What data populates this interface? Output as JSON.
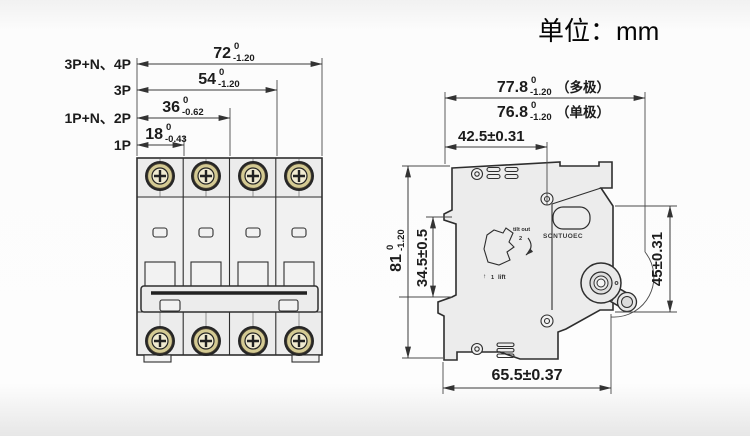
{
  "unit_label": "单位：mm",
  "front": {
    "labels": [
      "3P+N、4P",
      "3P",
      "1P+N、2P",
      "1P"
    ],
    "dims": [
      {
        "v": "72",
        "sup": "0",
        "sub": "-1.20"
      },
      {
        "v": "54",
        "sup": "0",
        "sub": "-1.20"
      },
      {
        "v": "36",
        "sup": "0",
        "sub": "-0.62"
      },
      {
        "v": "18",
        "sup": "0",
        "sub": "-0.43"
      }
    ]
  },
  "side": {
    "multi": {
      "v": "77.8",
      "sup": "0",
      "sub": "-1.20",
      "qual": "（多极）"
    },
    "single": {
      "v": "76.8",
      "sup": "0",
      "sub": "-1.20",
      "qual": "（单极）"
    },
    "d425": "42.5±0.31",
    "d81": {
      "v": "81",
      "sup": "0",
      "sub": "-1.20"
    },
    "d345": "34.5±0.5",
    "d45": "45±0.31",
    "d655": "65.5±0.37"
  },
  "marks": {
    "brand": "SONTUOEC",
    "tilt": "tilt out",
    "tilt_n": "2",
    "lift_arrow": "↑",
    "lift_n": "1",
    "lift": "lift"
  },
  "colors": {
    "line": "#333333",
    "body_fill": "#ececec",
    "screw_brass": "#d4ca93",
    "screw_center": "#f0ead0",
    "background": "#fdfdfd"
  }
}
